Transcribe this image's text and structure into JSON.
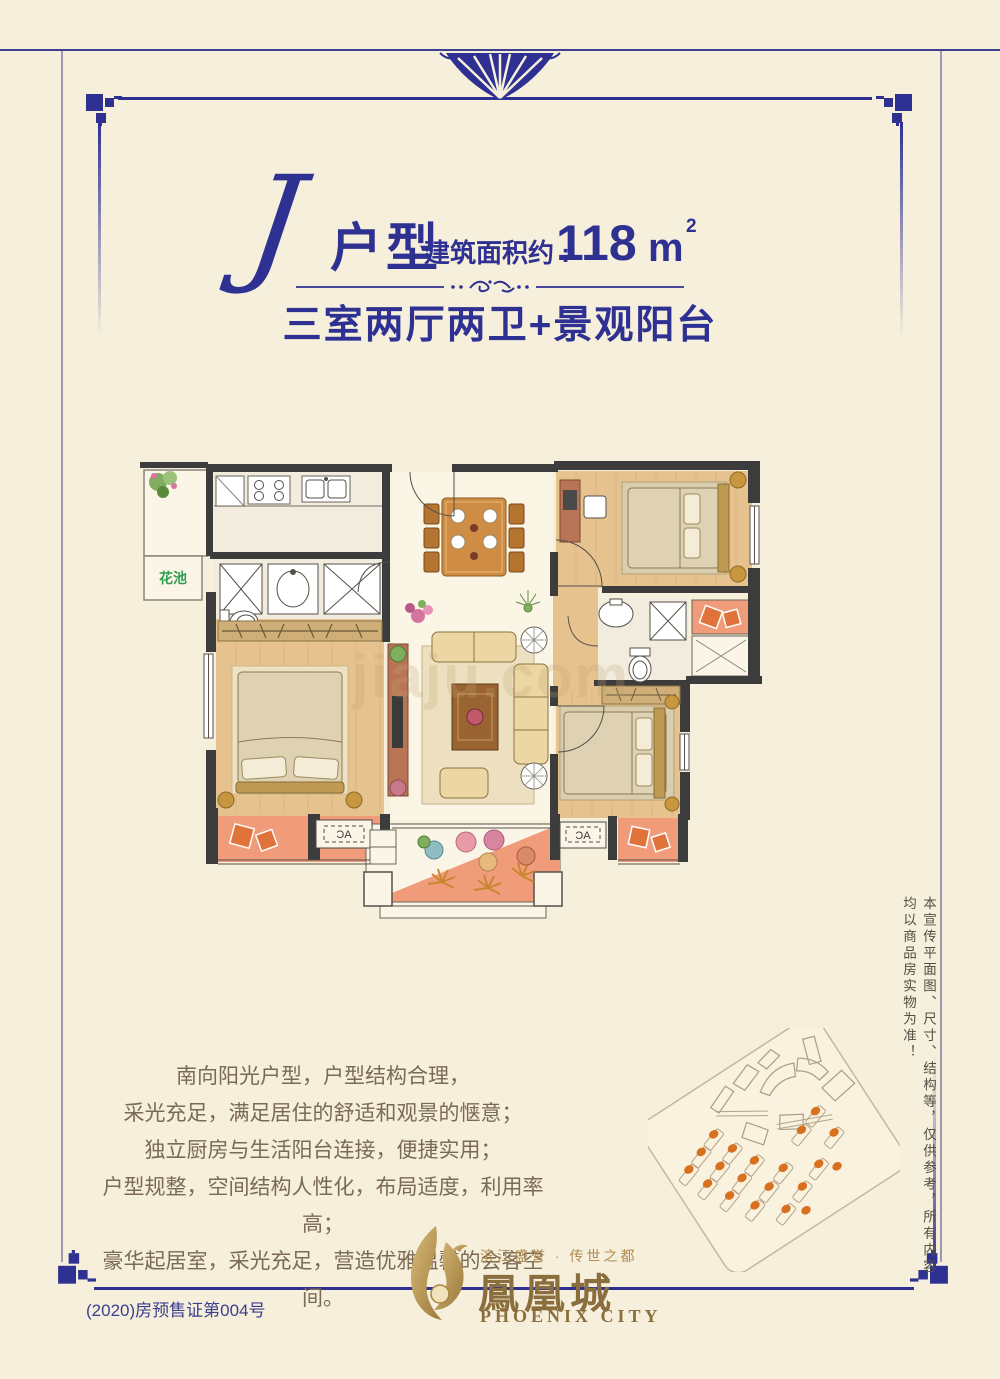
{
  "title": {
    "unit_letter": "J",
    "unit_type_label": "户型",
    "area_label": "建筑面积约 :",
    "area_value": "118",
    "area_unit_base": "m",
    "area_unit_sup": "2",
    "subtitle": "三室两厅两卫+景观阳台"
  },
  "floor_plan": {
    "flower_bed_label": "花池",
    "ac_label": "AC",
    "watermark": "jiaju.com"
  },
  "description": {
    "lines": [
      "南向阳光户型，户型结构合理，",
      "采光充足，满足居住的舒适和观景的惬意；",
      "独立厨房与生活阳台连接，便捷实用；",
      "户型规整，空间结构人性化，布局适度，利用率高；",
      "豪华起居室，采光充足，营造优雅温馨的会客空间。"
    ]
  },
  "disclaimer": {
    "vertical_text": "本宣传平面图、尺寸、结构等，仅供参考，所有内容均以商品房实物为准！"
  },
  "logo": {
    "tagline": "滨江盛誉 · 传世之都",
    "name_cn": "鳳凰城",
    "name_en": "PHOENIX CITY"
  },
  "footer": {
    "presale_permit": "(2020)房预售证第004号"
  },
  "colors": {
    "accent_blue": "#2e3192",
    "gold": "#a8863f",
    "salmon": "#f09c7a",
    "green_label": "#2e9e4f"
  }
}
